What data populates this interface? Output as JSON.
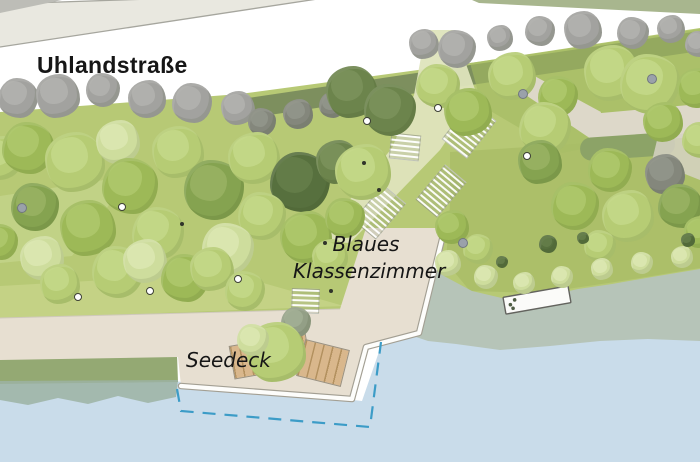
{
  "labels": {
    "street": "Uhlandstraße",
    "classroom_line1": "Blaues",
    "classroom_line2": "Klassenzimmer",
    "deck": "Seedeck"
  },
  "palette": {
    "background": "#ffffff",
    "road": "#e9e8e0",
    "road_line": "#a6a69e",
    "corner_gray": "#bdbdb7",
    "top_band": "#a8b68e",
    "lawn": "#b7c975",
    "olive_band": "#75865b",
    "lawn_dark_upper": "#a3ba61",
    "lawn_mid_right": "#a9bd66",
    "lawn_pale_left": "#cbd893",
    "lawn_pale_strip": "#c9d68c",
    "path_pale": "#dee4bc",
    "path_beige": "#ddd8c9",
    "hedge": "#8ca367",
    "paving": "#e7dfd1",
    "edge_white": "#fdfdfb",
    "edge_gray": "#a39f93",
    "shore_band": "#94a973",
    "shore_wave": "#9cb3a3",
    "water": "#c9dcea",
    "wetland": "#b6c4b8",
    "dash_blue": "#3c9cc7",
    "jetty_fill": "#fbfbf9",
    "jetty_border": "#63635e",
    "wood": "#d9b78c",
    "wood_line": "#b3915f",
    "wood_border": "#9a9180",
    "label_text": "#161616",
    "tree_colors": {
      "pale": "#cedd9d",
      "light": "#b6cc74",
      "mid": "#9db957",
      "dark": "#85a350",
      "olive": "#6c844c",
      "deepolive": "#57703e",
      "gray": "#a2a29f",
      "darkgray": "#84877c",
      "graygreen": "#939f86"
    },
    "tree_highlights": {
      "pale": "#dde8b4",
      "light": "#c6d98b",
      "mid": "#b0c96e",
      "dark": "#9ab364",
      "olive": "#7d945c",
      "deepolive": "#66804b",
      "gray": "#b4b4b0",
      "darkgray": "#94978c",
      "graygreen": "#a4b096"
    }
  },
  "scene": {
    "trees": [
      [
        18,
        98,
        20,
        "gray"
      ],
      [
        58,
        96,
        22,
        "gray"
      ],
      [
        103,
        90,
        17,
        "gray"
      ],
      [
        147,
        99,
        19,
        "gray"
      ],
      [
        192,
        103,
        20,
        "gray"
      ],
      [
        238,
        108,
        17,
        "gray"
      ],
      [
        262,
        122,
        14,
        "darkgray"
      ],
      [
        298,
        114,
        15,
        "darkgray"
      ],
      [
        332,
        105,
        13,
        "darkgray"
      ],
      [
        424,
        44,
        15,
        "gray"
      ],
      [
        457,
        49,
        19,
        "gray"
      ],
      [
        500,
        38,
        13,
        "gray"
      ],
      [
        540,
        31,
        15,
        "gray"
      ],
      [
        583,
        30,
        19,
        "gray"
      ],
      [
        633,
        33,
        16,
        "gray"
      ],
      [
        671,
        29,
        14,
        "gray"
      ],
      [
        698,
        44,
        13,
        "gray"
      ],
      [
        352,
        92,
        26,
        "olive"
      ],
      [
        390,
        110,
        26,
        "olive"
      ],
      [
        0,
        158,
        22,
        "light"
      ],
      [
        28,
        148,
        26,
        "mid"
      ],
      [
        75,
        162,
        30,
        "light"
      ],
      [
        35,
        207,
        24,
        "dark"
      ],
      [
        118,
        142,
        22,
        "pale"
      ],
      [
        130,
        186,
        28,
        "mid"
      ],
      [
        178,
        152,
        26,
        "light"
      ],
      [
        214,
        190,
        30,
        "dark"
      ],
      [
        254,
        158,
        26,
        "light"
      ],
      [
        300,
        182,
        30,
        "deepolive"
      ],
      [
        338,
        162,
        22,
        "olive"
      ],
      [
        262,
        216,
        24,
        "light"
      ],
      [
        306,
        237,
        26,
        "mid"
      ],
      [
        158,
        233,
        26,
        "light"
      ],
      [
        88,
        228,
        28,
        "mid"
      ],
      [
        228,
        249,
        26,
        "pale"
      ],
      [
        42,
        258,
        22,
        "pale"
      ],
      [
        0,
        242,
        18,
        "mid"
      ],
      [
        60,
        284,
        20,
        "light"
      ],
      [
        118,
        272,
        26,
        "light"
      ],
      [
        145,
        261,
        22,
        "pale"
      ],
      [
        185,
        278,
        24,
        "mid"
      ],
      [
        212,
        269,
        22,
        "light"
      ],
      [
        245,
        291,
        20,
        "light"
      ],
      [
        363,
        172,
        28,
        "light"
      ],
      [
        438,
        86,
        22,
        "light"
      ],
      [
        468,
        112,
        24,
        "mid"
      ],
      [
        345,
        218,
        20,
        "mid"
      ],
      [
        330,
        257,
        18,
        "light"
      ],
      [
        296,
        322,
        15,
        "graygreen"
      ],
      [
        276,
        352,
        30,
        "light"
      ],
      [
        253,
        340,
        16,
        "pale"
      ],
      [
        512,
        76,
        24,
        "light"
      ],
      [
        558,
        96,
        20,
        "mid"
      ],
      [
        612,
        73,
        28,
        "light"
      ],
      [
        650,
        84,
        30,
        "light"
      ],
      [
        697,
        88,
        20,
        "mid"
      ],
      [
        545,
        128,
        26,
        "light"
      ],
      [
        540,
        162,
        22,
        "dark"
      ],
      [
        610,
        170,
        22,
        "mid"
      ],
      [
        663,
        122,
        20,
        "mid"
      ],
      [
        700,
        140,
        18,
        "light"
      ],
      [
        665,
        174,
        20,
        "darkgray"
      ],
      [
        575,
        206,
        24,
        "mid"
      ],
      [
        628,
        216,
        26,
        "light"
      ],
      [
        680,
        206,
        22,
        "dark"
      ],
      [
        700,
        232,
        16,
        "mid"
      ],
      [
        600,
        246,
        16,
        "light"
      ],
      [
        452,
        227,
        17,
        "mid"
      ],
      [
        478,
        249,
        15,
        "light"
      ],
      [
        448,
        263,
        13,
        "pale"
      ],
      [
        486,
        277,
        12,
        "pale"
      ],
      [
        524,
        283,
        11,
        "pale"
      ],
      [
        562,
        277,
        11,
        "pale"
      ],
      [
        602,
        269,
        11,
        "pale"
      ],
      [
        642,
        263,
        11,
        "pale"
      ],
      [
        682,
        257,
        11,
        "pale"
      ],
      [
        548,
        244,
        9,
        "deepolive"
      ],
      [
        583,
        238,
        6,
        "deepolive"
      ],
      [
        502,
        262,
        6,
        "deepolive"
      ],
      [
        688,
        240,
        7,
        "deepolive"
      ]
    ],
    "markers": [
      {
        "x": 122,
        "y": 207,
        "t": "white"
      },
      {
        "x": 367,
        "y": 121,
        "t": "white"
      },
      {
        "x": 438,
        "y": 108,
        "t": "white"
      },
      {
        "x": 527,
        "y": 156,
        "t": "white"
      },
      {
        "x": 78,
        "y": 297,
        "t": "white"
      },
      {
        "x": 150,
        "y": 291,
        "t": "white"
      },
      {
        "x": 238,
        "y": 279,
        "t": "white"
      },
      {
        "x": 22,
        "y": 208,
        "t": "gray"
      },
      {
        "x": 463,
        "y": 243,
        "t": "gray"
      },
      {
        "x": 652,
        "y": 79,
        "t": "gray"
      },
      {
        "x": 523,
        "y": 94,
        "t": "gray"
      },
      {
        "x": 364,
        "y": 163,
        "t": "black"
      },
      {
        "x": 379,
        "y": 190,
        "t": "black"
      },
      {
        "x": 331,
        "y": 291,
        "t": "black"
      },
      {
        "x": 325,
        "y": 243,
        "t": "black"
      },
      {
        "x": 182,
        "y": 224,
        "t": "black"
      }
    ],
    "stairs": [
      {
        "x": 468,
        "y": 129,
        "w": 46,
        "h": 30,
        "a": -52
      },
      {
        "x": 404,
        "y": 146,
        "w": 24,
        "h": 28,
        "a": 96
      },
      {
        "x": 440,
        "y": 190,
        "w": 44,
        "h": 26,
        "a": -50
      },
      {
        "x": 378,
        "y": 211,
        "w": 45,
        "h": 28,
        "a": -50
      },
      {
        "x": 304,
        "y": 300,
        "w": 23,
        "h": 26,
        "a": 92
      }
    ],
    "wood_decks": [
      {
        "x": 270,
        "y": 356,
        "w": 78,
        "h": 34,
        "a": -10
      },
      {
        "x": 323,
        "y": 363,
        "w": 46,
        "h": 38,
        "a": 14
      }
    ]
  }
}
